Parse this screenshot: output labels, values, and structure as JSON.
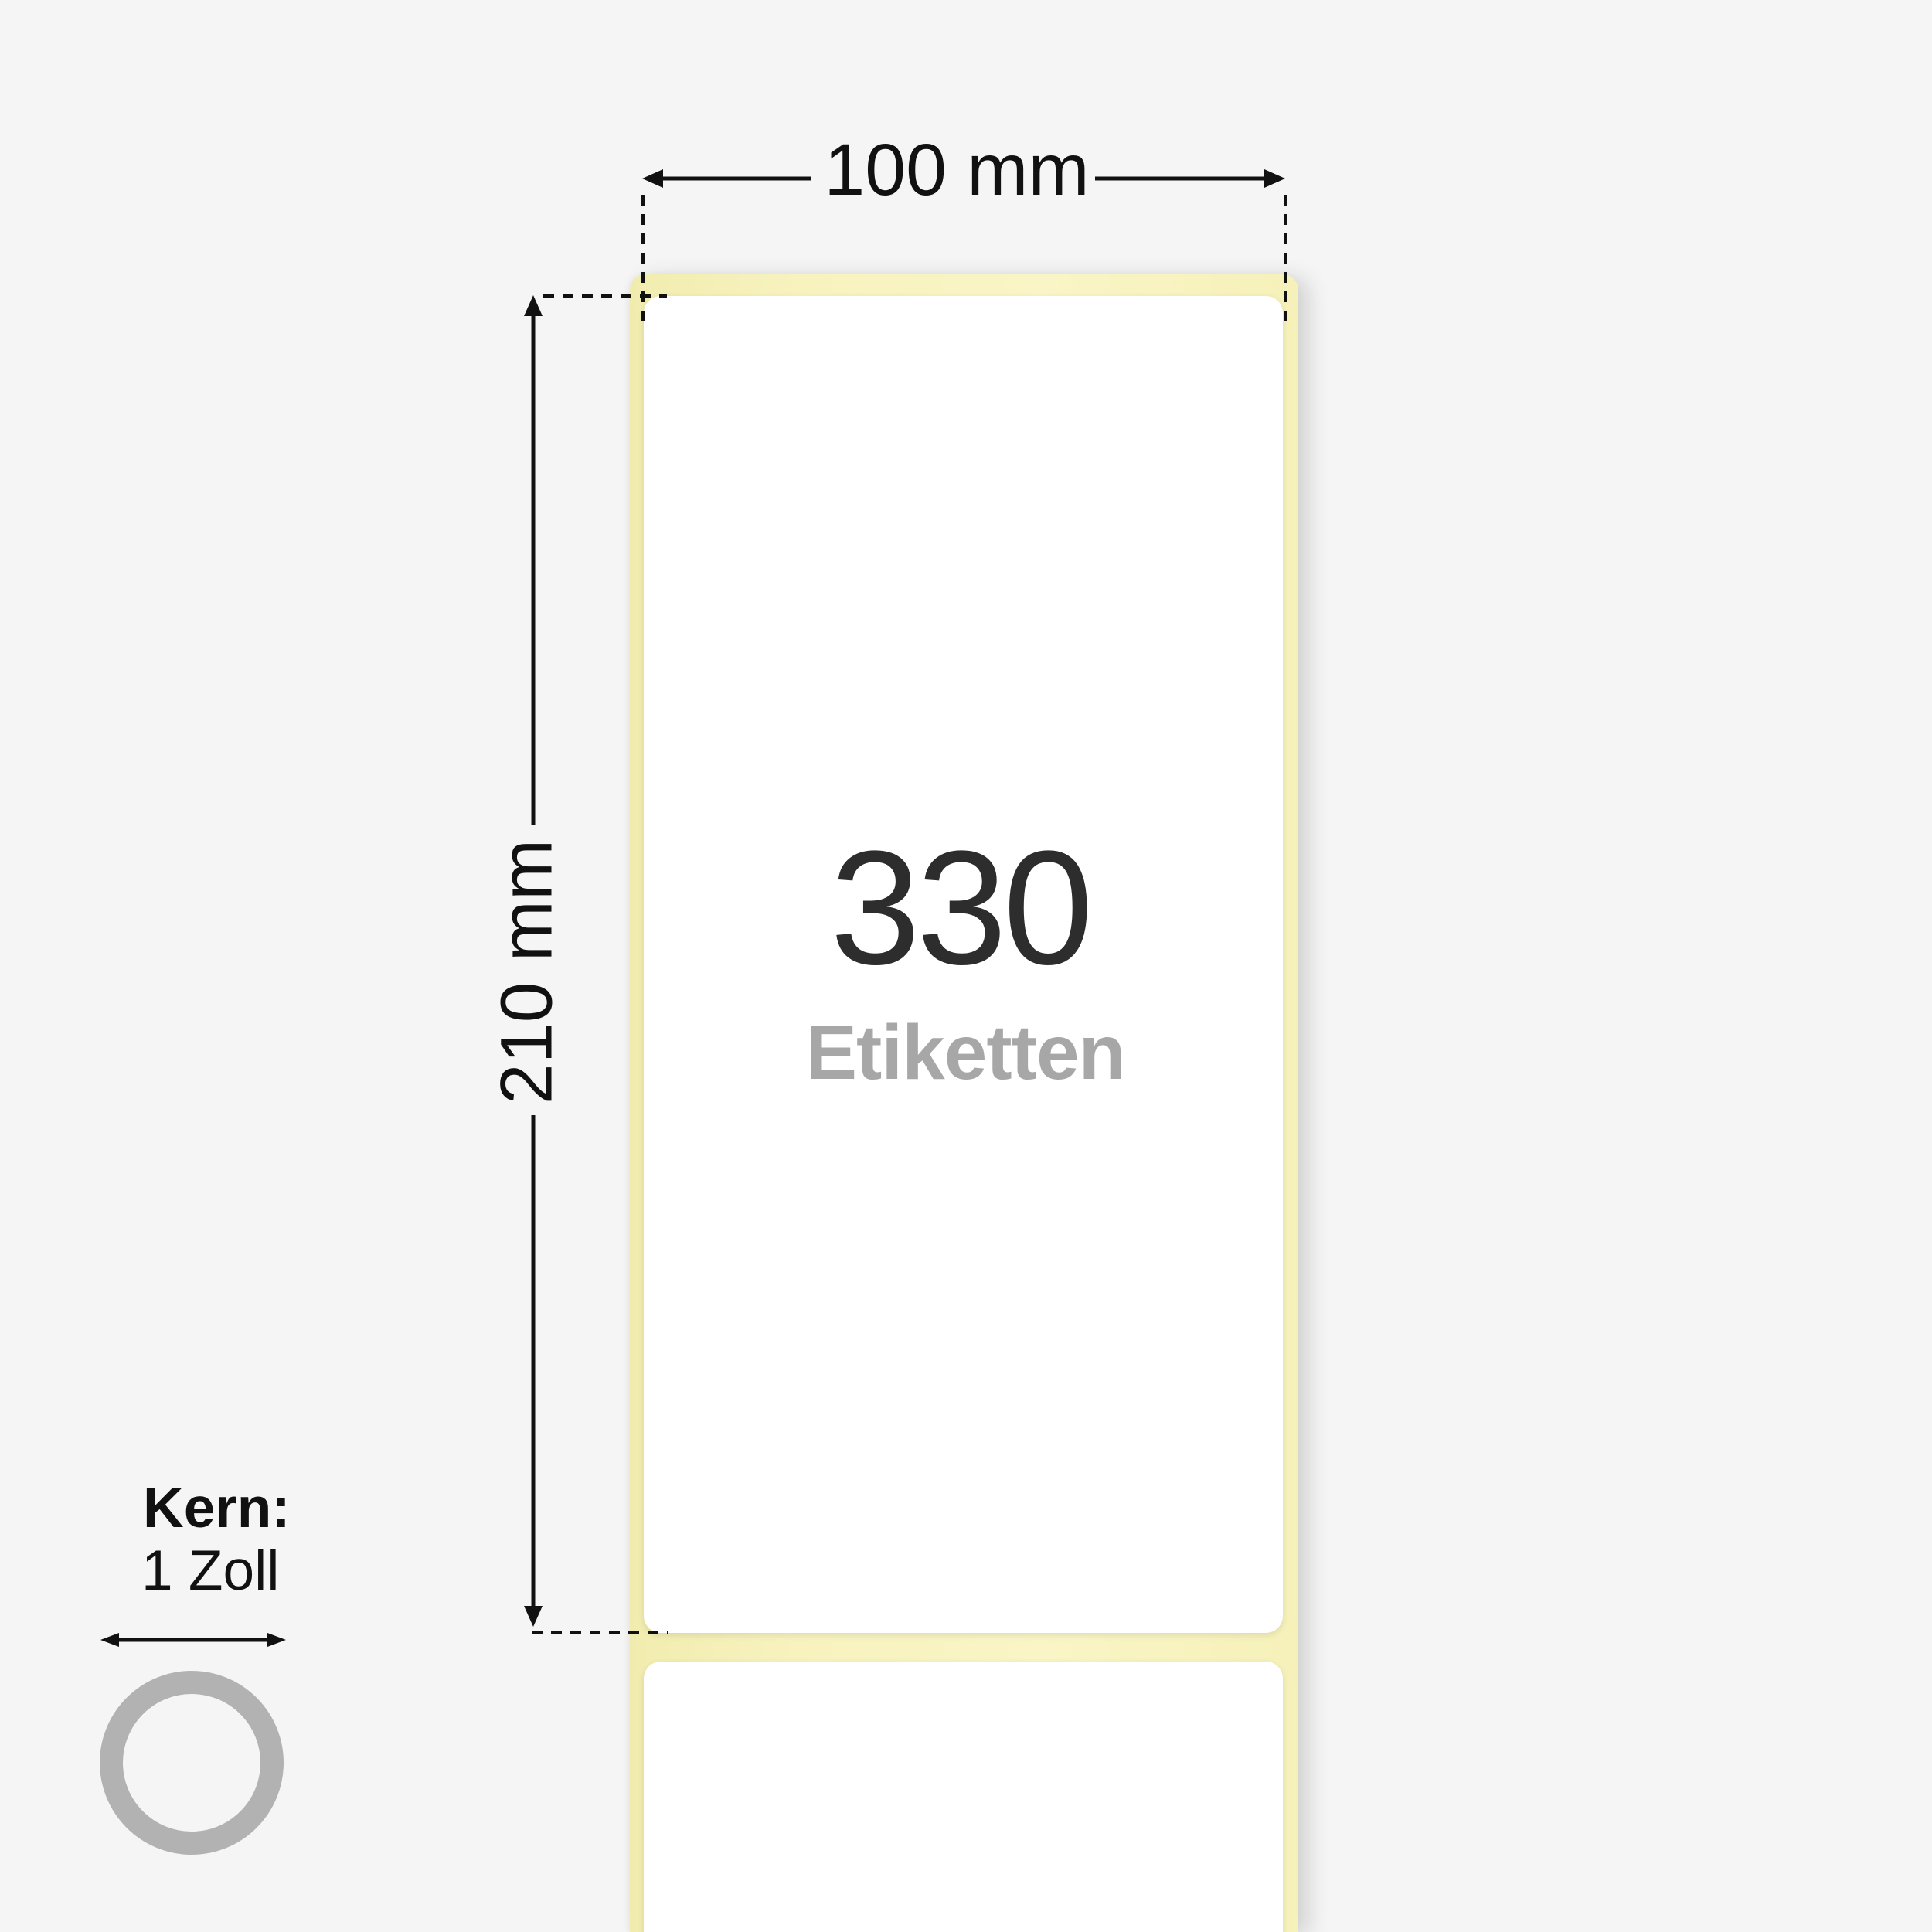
{
  "diagram": {
    "type": "label-roll-product-dimension-diagram"
  },
  "dimensions": {
    "width_label": "100 mm",
    "height_label": "210 mm"
  },
  "label_roll": {
    "count": "330",
    "unit": "Etiketten",
    "backing_color": "#f7f2bd",
    "label_color": "#ffffff"
  },
  "core": {
    "title": "Kern:",
    "value": "1 Zoll",
    "ring_color": "#b2b2b2"
  },
  "colors": {
    "background": "#f5f5f6",
    "line": "#111111",
    "count_text": "#2d2d2d",
    "unit_text": "#a7a7a7"
  }
}
